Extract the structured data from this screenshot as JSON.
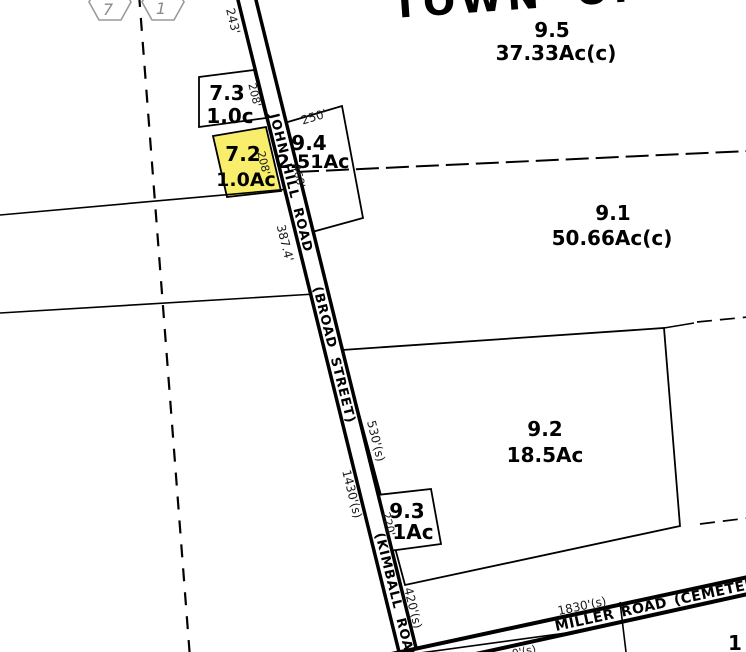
{
  "map_title": "TOWN OF M",
  "index_hexagons": {
    "left": "7",
    "right": "1"
  },
  "parcels": {
    "p9_5": {
      "id": "9.5",
      "area": "37.33Ac(c)"
    },
    "p7_3": {
      "id": "7.3",
      "area": "1.0c"
    },
    "p9_4": {
      "id": "9.4",
      "area": "2.51Ac"
    },
    "p7_2": {
      "id": "7.2",
      "area": "1.0Ac",
      "highlighted": true
    },
    "p9_1": {
      "id": "9.1",
      "area": "50.66Ac(c)"
    },
    "p9_2": {
      "id": "9.2",
      "area": "18.5Ac"
    },
    "p9_3": {
      "id": "9.3",
      "area": "1Ac"
    },
    "partial_bottom_right": {
      "id": "1"
    }
  },
  "roads": {
    "john_hill": "JOHN HILL ROAD",
    "broad": "(BROAD STREET)",
    "kimball": "(KIMBALL ROAD)",
    "miller": "MILLER ROAD (CEMETERY RD"
  },
  "measurements": {
    "main_243": "243'",
    "front_7_3_208": "208'",
    "front_7_2_208": "208'",
    "p9_4_250": "250'",
    "p9_4_468": "468'",
    "main_387": "387.4'",
    "p9_2_530": "530'(s)",
    "main_1430": "1430'(s)",
    "p9_3_220": "220'",
    "main_420": "420'(s)",
    "miller_1830": "1830'(s)",
    "bottom_partial": "0'(s)"
  },
  "colors": {
    "highlight_fill": "#F9EE6B",
    "line": "#000000",
    "hex_outline": "#9a9a9a"
  }
}
